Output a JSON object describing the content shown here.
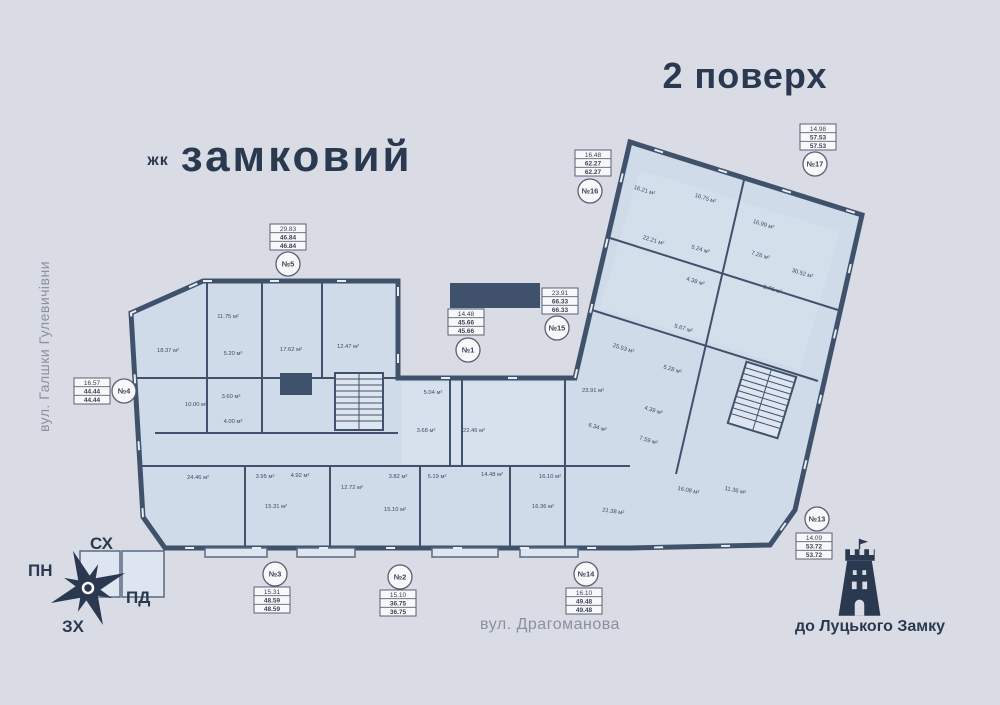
{
  "title": "2 поверх",
  "logo": {
    "prefix": "жк",
    "name": "замковий"
  },
  "streets": {
    "left": "вул. Галшки Гулевичівни",
    "bottom": "вул. Драгоманова"
  },
  "compass": {
    "top": "СХ",
    "left": "ПН",
    "right": "ПД",
    "bottom": "ЗХ"
  },
  "landmark": {
    "label": "до Луцького Замку"
  },
  "colors": {
    "background": "#d9dce5",
    "wall": "#40526b",
    "room_fill": "#cfdbe9",
    "room_fill_light": "#dde6f0",
    "label_text": "#3d4a63",
    "marker_border": "#5a6172",
    "marker_bg": "#f7f8fa",
    "accent_dark": "#2b3950",
    "street_text": "#8b90a0"
  },
  "apartments": [
    {
      "id": "№5",
      "values": [
        "29.83",
        "46.84",
        "46.84"
      ],
      "box": [
        288,
        237
      ],
      "circle": [
        288,
        264
      ]
    },
    {
      "id": "№16",
      "values": [
        "16.48",
        "62.27",
        "62.27"
      ],
      "box": [
        593,
        163
      ],
      "circle": [
        590,
        191
      ]
    },
    {
      "id": "№17",
      "values": [
        "14.98",
        "57.53",
        "57.53"
      ],
      "box": [
        818,
        137
      ],
      "circle": [
        815,
        164
      ]
    },
    {
      "id": "№1",
      "values": [
        "14.48",
        "45.66",
        "45.66"
      ],
      "box": [
        466,
        322
      ],
      "circle": [
        468,
        350
      ]
    },
    {
      "id": "№15",
      "values": [
        "23.91",
        "66.33",
        "66.33"
      ],
      "box": [
        560,
        301
      ],
      "circle": [
        557,
        328
      ]
    },
    {
      "id": "№4",
      "values": [
        "16.57",
        "44.44",
        "44.44"
      ],
      "box": [
        92,
        391
      ],
      "circle": [
        124,
        391
      ]
    },
    {
      "id": "№3",
      "values": [
        "15.31",
        "48.59",
        "48.59"
      ],
      "box": [
        272,
        600
      ],
      "circle": [
        275,
        574
      ]
    },
    {
      "id": "№2",
      "values": [
        "15.10",
        "36.75",
        "36.75"
      ],
      "box": [
        398,
        603
      ],
      "circle": [
        400,
        577
      ]
    },
    {
      "id": "№14",
      "values": [
        "16.10",
        "49.48",
        "49.48"
      ],
      "box": [
        584,
        601
      ],
      "circle": [
        586,
        574
      ]
    },
    {
      "id": "№13",
      "values": [
        "14.09",
        "53.72",
        "53.72"
      ],
      "box": [
        814,
        546
      ],
      "circle": [
        817,
        519
      ]
    }
  ],
  "rooms": [
    {
      "label": "18.37 м²",
      "x": 168,
      "y": 352,
      "r": 0
    },
    {
      "label": "11.75 м²",
      "x": 228,
      "y": 318,
      "r": 0
    },
    {
      "label": "5.20 м²",
      "x": 233,
      "y": 355,
      "r": 0
    },
    {
      "label": "17.62 м²",
      "x": 291,
      "y": 351,
      "r": 0
    },
    {
      "label": "12.47 м²",
      "x": 348,
      "y": 348,
      "r": 0
    },
    {
      "label": "10.00 м²",
      "x": 196,
      "y": 406,
      "r": 0
    },
    {
      "label": "3.60 м²",
      "x": 231,
      "y": 398,
      "r": 0
    },
    {
      "label": "4.00 м²",
      "x": 233,
      "y": 423,
      "r": 0
    },
    {
      "label": "24.46 м²",
      "x": 198,
      "y": 479,
      "r": 0
    },
    {
      "label": "3.95 м²",
      "x": 265,
      "y": 478,
      "r": 0
    },
    {
      "label": "4.92 м²",
      "x": 300,
      "y": 477,
      "r": 0
    },
    {
      "label": "15.31 м²",
      "x": 276,
      "y": 508,
      "r": 0
    },
    {
      "label": "12.72 м²",
      "x": 352,
      "y": 489,
      "r": 0
    },
    {
      "label": "15.10 м²",
      "x": 395,
      "y": 511,
      "r": 0
    },
    {
      "label": "5.04 м²",
      "x": 433,
      "y": 394,
      "r": 0
    },
    {
      "label": "3.68 м²",
      "x": 426,
      "y": 432,
      "r": 0
    },
    {
      "label": "22.46 м²",
      "x": 474,
      "y": 432,
      "r": 0
    },
    {
      "label": "3.82 м²",
      "x": 398,
      "y": 478,
      "r": 0
    },
    {
      "label": "5.19 м²",
      "x": 437,
      "y": 478,
      "r": 0
    },
    {
      "label": "14.48 м²",
      "x": 492,
      "y": 476,
      "r": 0
    },
    {
      "label": "16.10 м²",
      "x": 550,
      "y": 478,
      "r": 0
    },
    {
      "label": "16.36 м²",
      "x": 543,
      "y": 508,
      "r": 0
    },
    {
      "label": "23.91 м²",
      "x": 593,
      "y": 392,
      "r": 0
    },
    {
      "label": "21.38 м²",
      "x": 613,
      "y": 513,
      "r": 8
    },
    {
      "label": "6.34 м²",
      "x": 597,
      "y": 429,
      "r": 17
    },
    {
      "label": "4.39 м²",
      "x": 653,
      "y": 412,
      "r": 17
    },
    {
      "label": "7.59 м²",
      "x": 648,
      "y": 442,
      "r": 17
    },
    {
      "label": "16.08 м²",
      "x": 688,
      "y": 492,
      "r": 12
    },
    {
      "label": "11.36 м²",
      "x": 735,
      "y": 492,
      "r": 12
    },
    {
      "label": "16.21 м²",
      "x": 644,
      "y": 192,
      "r": 17
    },
    {
      "label": "16.75 м²",
      "x": 705,
      "y": 200,
      "r": 17
    },
    {
      "label": "22.21 м²",
      "x": 653,
      "y": 242,
      "r": 17
    },
    {
      "label": "5.24 м²",
      "x": 700,
      "y": 251,
      "r": 17
    },
    {
      "label": "4.38 м²",
      "x": 695,
      "y": 283,
      "r": 17
    },
    {
      "label": "16.99 м²",
      "x": 763,
      "y": 226,
      "r": 17
    },
    {
      "label": "7.26 м²",
      "x": 760,
      "y": 257,
      "r": 17
    },
    {
      "label": "30.52 м²",
      "x": 802,
      "y": 275,
      "r": 17
    },
    {
      "label": "5.76 м²",
      "x": 772,
      "y": 291,
      "r": 17
    },
    {
      "label": "5.67 м²",
      "x": 683,
      "y": 330,
      "r": 17
    },
    {
      "label": "25.53 м²",
      "x": 623,
      "y": 350,
      "r": 17
    },
    {
      "label": "5.28 м²",
      "x": 672,
      "y": 371,
      "r": 17
    }
  ]
}
